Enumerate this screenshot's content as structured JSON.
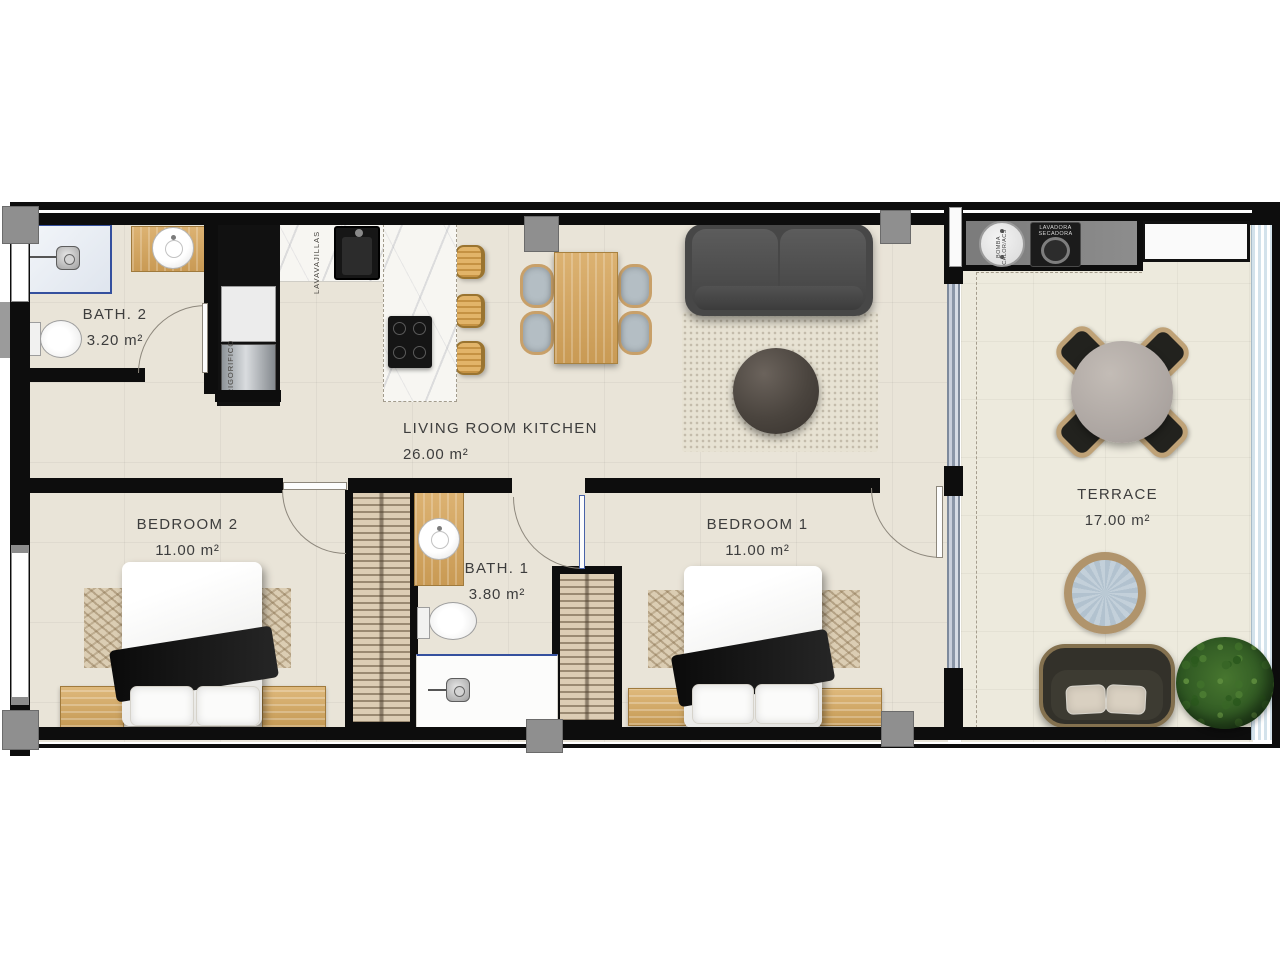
{
  "plan": {
    "type": "apartment-floor-plan",
    "rooms": [
      {
        "id": "bath-2",
        "name": "BATH. 2",
        "area": "3.20 m²"
      },
      {
        "id": "living",
        "name": "LIVING ROOM KITCHEN",
        "area": "26.00 m²"
      },
      {
        "id": "bedroom-2",
        "name": "BEDROOM 2",
        "area": "11.00 m²"
      },
      {
        "id": "bath-1",
        "name": "BATH. 1",
        "area": "3.80 m²"
      },
      {
        "id": "bedroom-1",
        "name": "BEDROOM 1",
        "area": "11.00 m²"
      },
      {
        "id": "terrace",
        "name": "TERRACE",
        "area": "17.00 m²"
      }
    ],
    "appliances": {
      "dishwasher": "LAVAVAJILLAS",
      "fridge": "FRIGORIFICO",
      "heat_pump_l1": "BOMBA",
      "heat_pump_l2": "CALOR/ACS",
      "washer_l1": "LAVADORA",
      "washer_l2": "SECADORA"
    },
    "colors": {
      "wall": "#0d0d0d",
      "floor": "#e9e4d8",
      "terrace_floor": "#edeadd",
      "wood": "#d3a868",
      "marble": "#f7f6f2",
      "accent_blue": "#2b57c8",
      "pillar_gray": "#8f8f8f"
    }
  }
}
